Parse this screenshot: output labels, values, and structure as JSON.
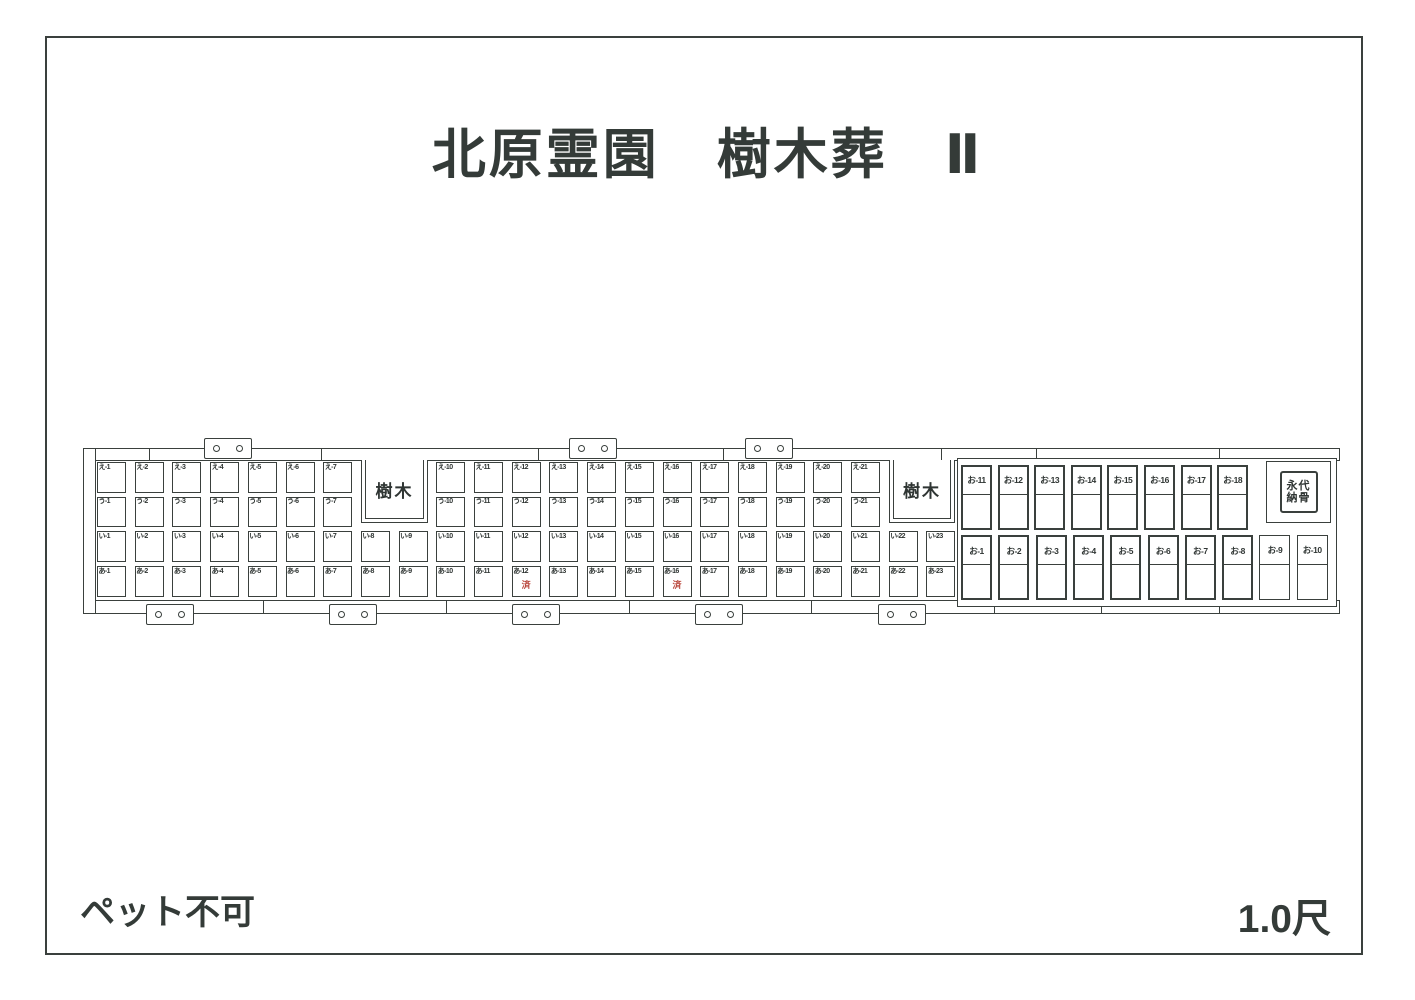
{
  "title": "北原霊園　樹木葬　Ⅱ",
  "footer": {
    "left": "ペット不可",
    "right": "1.0尺"
  },
  "colors": {
    "line": "#3a403d",
    "sold_red": "#b9453b"
  },
  "map": {
    "tree_label": "樹木",
    "eternal_line1": "永代",
    "eternal_line2": "納骨",
    "sold_label": "済",
    "sold_plots": [
      "あ-12",
      "あ-16"
    ],
    "grid_rows": [
      {
        "prefix": "え",
        "segments": [
          {
            "start_col": 1,
            "labels": [
              "え-1",
              "え-2",
              "え-3",
              "え-4",
              "え-5",
              "え-6",
              "え-7"
            ]
          },
          {
            "start_col": 10,
            "labels": [
              "え-10",
              "え-11",
              "え-12",
              "え-13",
              "え-14",
              "え-15",
              "え-16",
              "え-17",
              "え-18",
              "え-19",
              "え-20",
              "え-21"
            ]
          }
        ]
      },
      {
        "prefix": "う",
        "segments": [
          {
            "start_col": 1,
            "labels": [
              "う-1",
              "う-2",
              "う-3",
              "う-4",
              "う-5",
              "う-6",
              "う-7"
            ]
          },
          {
            "start_col": 10,
            "labels": [
              "う-10",
              "う-11",
              "う-12",
              "う-13",
              "う-14",
              "う-15",
              "う-16",
              "う-17",
              "う-18",
              "う-19",
              "う-20",
              "う-21"
            ]
          }
        ]
      },
      {
        "prefix": "い",
        "segments": [
          {
            "start_col": 1,
            "labels": [
              "い-1",
              "い-2",
              "い-3",
              "い-4",
              "い-5",
              "い-6",
              "い-7",
              "い-8",
              "い-9",
              "い-10",
              "い-11",
              "い-12",
              "い-13",
              "い-14",
              "い-15",
              "い-16",
              "い-17",
              "い-18",
              "い-19",
              "い-20",
              "い-21",
              "い-22",
              "い-23"
            ]
          }
        ]
      },
      {
        "prefix": "あ",
        "segments": [
          {
            "start_col": 1,
            "labels": [
              "あ-1",
              "あ-2",
              "あ-3",
              "あ-4",
              "あ-5",
              "あ-6",
              "あ-7",
              "あ-8",
              "あ-9",
              "あ-10",
              "あ-11",
              "あ-12",
              "あ-13",
              "あ-14",
              "あ-15",
              "あ-16",
              "あ-17",
              "あ-18",
              "あ-19",
              "あ-20",
              "あ-21",
              "あ-22",
              "あ-23"
            ]
          }
        ]
      }
    ],
    "o_section": {
      "top_labels": [
        "お-11",
        "お-12",
        "お-13",
        "お-14",
        "お-15",
        "お-16",
        "お-17",
        "お-18"
      ],
      "bottom_labels": [
        "お-1",
        "お-2",
        "お-3",
        "お-4",
        "お-5",
        "お-6",
        "お-7",
        "お-8",
        "お-9",
        "お-10"
      ],
      "thin_border_labels": [
        "お-9",
        "お-10"
      ]
    }
  }
}
